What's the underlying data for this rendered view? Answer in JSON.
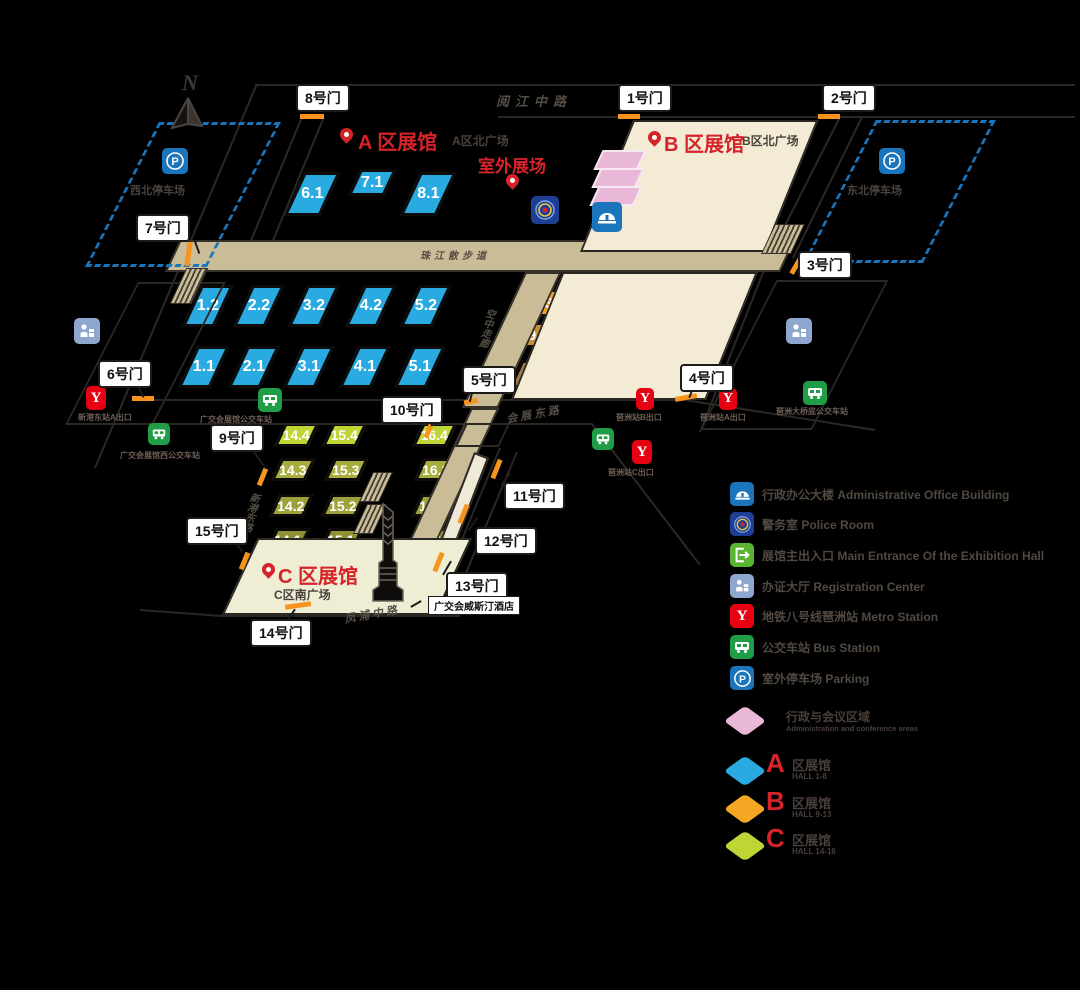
{
  "north": "N",
  "roads": {
    "yuejiang": "阅江中路",
    "promenade": "珠江散步道",
    "skywalk": "空中走廊",
    "huizhan_east": "会展东路",
    "fengpu_middle": "凤浦中路",
    "xingang_east": "新港东路"
  },
  "zones": {
    "a": {
      "title": "A 区展馆",
      "plaza": "A区北广场",
      "outdoor": "室外展场"
    },
    "b": {
      "title": "B 区展馆",
      "plaza": "B区北广场"
    },
    "c": {
      "title": "C 区展馆",
      "plaza": "C区南广场"
    }
  },
  "halls": {
    "a_top": [
      "6.1",
      "7.1",
      "8.1"
    ],
    "a_upper": [
      "1.2",
      "2.2",
      "3.2",
      "4.2",
      "5.2"
    ],
    "a_lower": [
      "1.1",
      "2.1",
      "3.1",
      "4.1",
      "5.1"
    ],
    "b_north": [
      "12.2",
      "13.2",
      "12.1",
      "13.1"
    ],
    "b_r3": [
      "9.3",
      "10.3",
      "11.3"
    ],
    "b_r2": [
      "9.2",
      "10.2",
      "11.2"
    ],
    "b_r1": [
      "9.1",
      "10.1",
      "11.1"
    ],
    "c_r4": [
      "14.4",
      "15.4",
      "16.4"
    ],
    "c_r3": [
      "14.3",
      "15.3",
      "16.3"
    ],
    "c_r2": [
      "14.2",
      "15.2",
      "16.2"
    ],
    "c_r1": [
      "14.1",
      "15.1",
      "16.1"
    ]
  },
  "gates": [
    "1号门",
    "2号门",
    "3号门",
    "4号门",
    "5号门",
    "6号门",
    "7号门",
    "8号门",
    "9号门",
    "10号门",
    "11号门",
    "12号门",
    "13号门",
    "14号门",
    "15号门"
  ],
  "places": {
    "parking_nw": "西北停车场",
    "parking_ne": "东北停车场",
    "westin": "广交会威斯汀酒店",
    "metro_xingang_a": "新港东站A出口",
    "metro_pazhou_b": "琶洲站B出口",
    "metro_pazhou_a": "琶洲站A出口",
    "metro_pazhou_c": "琶洲站C出口",
    "bus_west": "广交会展馆公交车站",
    "bus_sw": "广交会展馆西公交车站",
    "bus_bridge": "琶洲大桥底公交车站"
  },
  "legend": {
    "items": [
      {
        "zh": "行政办公大楼",
        "en": "Administrative Office Building"
      },
      {
        "zh": "警务室",
        "en": "Police Room"
      },
      {
        "zh": "展馆主出入口",
        "en": "Main Entrance Of the Exhibition Hall"
      },
      {
        "zh": "办证大厅",
        "en": "Registration Center"
      },
      {
        "zh": "地铁八号线琶洲站",
        "en": "Metro Station"
      },
      {
        "zh": "公交车站",
        "en": "Bus Station"
      },
      {
        "zh": "室外停车场",
        "en": "Parking"
      }
    ],
    "zone_rows": [
      {
        "letter": "",
        "zh": "行政与会议区域",
        "en": "Administration and conference areas",
        "color": "#E9B8D9"
      },
      {
        "letter": "A",
        "zh": "区展馆",
        "en": "HALL 1-8",
        "color": "#29ABE2"
      },
      {
        "letter": "B",
        "zh": "区展馆",
        "en": "HALL 9-13",
        "color": "#F5A623"
      },
      {
        "letter": "C",
        "zh": "区展馆",
        "en": "HALL 14-16",
        "color": "#BFD435"
      }
    ]
  },
  "colors": {
    "zone_a": "#29ABE2",
    "zone_b": "#F5A623",
    "zone_c": "#BFD435",
    "admin_pink": "#E9B8D9",
    "accent_red": "#D6232A",
    "gate_mark": "#F7941D",
    "walkway_tan": "#C9BC96",
    "plaza_cream": "#F3EBD3"
  }
}
